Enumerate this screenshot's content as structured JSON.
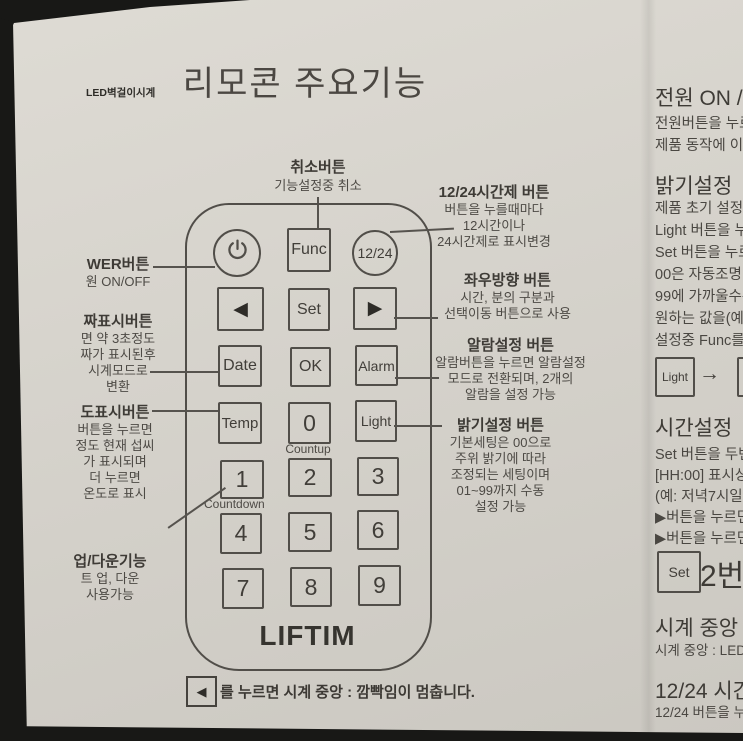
{
  "page": {
    "watermark": "LED벽걸이시계",
    "title": "리모콘 주요기능"
  },
  "colors": {
    "paper": "#d6d3cc",
    "ink": "#4b4843",
    "outline": "#514e49",
    "photo_edge": "#181816"
  },
  "remote": {
    "brand": "LIFTIM",
    "power_icon": "power-symbol",
    "func_label": "Func",
    "t1224_label": "12/24",
    "left_arrow_glyph": "◀",
    "set_label": "Set",
    "right_arrow_glyph": "▶",
    "date_label": "Date",
    "ok_label": "OK",
    "alarm_label": "Alarm",
    "temp_label": "Temp",
    "zero_label": "0",
    "light_label": "Light",
    "countup_label": "Countup",
    "countdown_label": "Countdown",
    "digits": [
      "1",
      "2",
      "3",
      "4",
      "5",
      "6",
      "7",
      "8",
      "9"
    ]
  },
  "annotations": {
    "cancel": {
      "title": "취소버튼",
      "line": "기능설정중 취소"
    },
    "left": [
      {
        "title": "WER버튼",
        "lines": [
          "원 ON/OFF"
        ]
      },
      {
        "title": "짜표시버튼",
        "lines": [
          "면 약 3초정도",
          "짜가 표시된후",
          "시계모드로",
          "변환"
        ]
      },
      {
        "title": "도표시버튼",
        "lines": [
          "버튼을 누르면",
          "정도 현재 섭씨",
          "가 표시되며",
          "더 누르면",
          "온도로 표시"
        ]
      },
      {
        "title": "업/다운기능",
        "lines": [
          "트 업, 다운",
          "사용가능"
        ]
      }
    ],
    "right": [
      {
        "title": "12/24시간제 버튼",
        "lines": [
          "버튼을 누를때마다",
          "12시간이나",
          "24시간제로 표시변경"
        ]
      },
      {
        "title": "좌우방향 버튼",
        "lines": [
          "시간, 분의 구분과",
          "선택이동 버튼으로 사용"
        ]
      },
      {
        "title": "알람설정 버튼",
        "lines": [
          "알람버튼을 누르면 알람설정",
          "모드로 전환되며, 2개의",
          "알람을 설정 가능"
        ]
      },
      {
        "title": "밝기설정 버튼",
        "lines": [
          "기본세팅은 00으로",
          "주위 밝기에 따라",
          "조정되는 세팅이며",
          "01~99까지 수동",
          "설정 가능"
        ]
      }
    ],
    "footnote": {
      "button_glyph": "◀",
      "text": "를 누르면 시계 중앙 : 깜빡임이 멈춥니다."
    }
  },
  "side_column": {
    "power": {
      "title": "전원 ON /",
      "lines": [
        "전원버튼을 누르",
        "제품 동작에 이상"
      ]
    },
    "brightness": {
      "title": "밝기설정",
      "lines": [
        "제품 초기 설정은",
        "Light 버튼을 누르",
        "Set 버튼을 누르",
        "00은 자동조명",
        "99에 가까울수록",
        "원하는 값을(예:",
        "설정중 Func를"
      ]
    },
    "light_diagram": {
      "button": "Light",
      "arrow": "→"
    },
    "time": {
      "title": "시간설정",
      "lines": [
        "Set 버튼을 두번",
        "[HH:00] 표시상",
        "(예: 저녁7시일경",
        "▶버튼을 누르면",
        "▶버튼을 누르면"
      ]
    },
    "set_diagram": {
      "button": "Set",
      "text": "2번"
    },
    "center": {
      "title": "시계 중앙 :",
      "lines": [
        "시계 중앙 : LED"
      ]
    },
    "t1224": {
      "title": "12/24 시간",
      "lines": [
        "12/24 버튼을 누"
      ]
    }
  }
}
